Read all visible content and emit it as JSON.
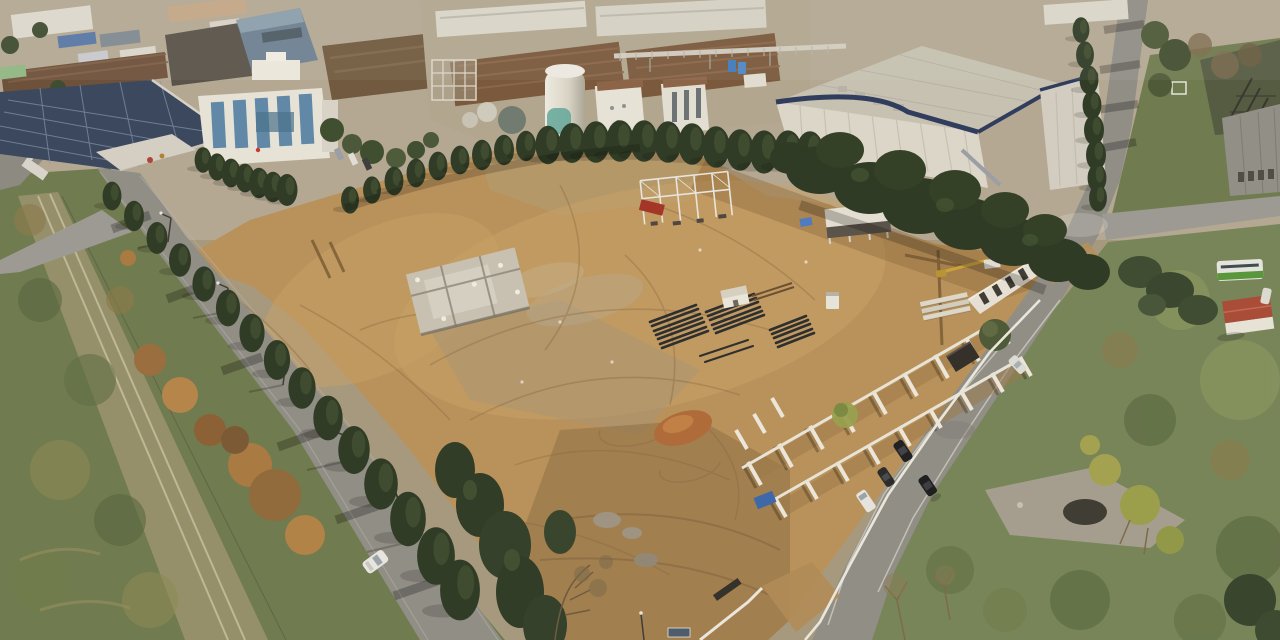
{
  "scene": {
    "kind": "aerial-drone-photograph",
    "subject": "Large cleared construction site with earthworks in an industrial district",
    "lighting": "low winter sun from upper right, long shadows cast to lower left",
    "season": "late autumn"
  },
  "palette": {
    "haze": "#b9b1a0",
    "earth": "#b9925c",
    "earth_light": "#cba76c",
    "earth_dark": "#8f6b42",
    "earth_gray": "#a59478",
    "grass": "#75855a",
    "grass_dark": "#55663f",
    "grass_light": "#8c9a62",
    "scrub": "#6d7a50",
    "tree_dark": "#2a3824",
    "tree_mid": "#3d4d30",
    "autumn": "#a87a42",
    "asphalt": "#8e8e88",
    "asphalt_light": "#9b9b95",
    "concrete": "#e9e7de",
    "concrete_shade": "#c6c3b6",
    "navy_fascia": "#2a3a5e",
    "solar_panel": "#36455e",
    "glass_blue": "#5d89ab",
    "roof_brown": "#77573d",
    "roof_red": "#a84a38",
    "silo_teal": "#5fa89e",
    "pipe_black": "#20262b",
    "tarp_blue": "#3a66ad",
    "machine_red": "#a33227",
    "crane_yellow": "#c9a33a",
    "bus_green": "#55963c",
    "rubble": "#c8c3b7"
  },
  "inventory": {
    "construction_site": [
      "cleared earth pad",
      "demolished building rubble",
      "steel frame under erection",
      "rows of precast L-shaped retaining walls",
      "stacks of black pipes",
      "reddish soil stockpile",
      "white site shed",
      "portable cabin",
      "blue tarp",
      "white perimeter fence with gate",
      "gravel piles"
    ],
    "buildings": [
      "warehouse with rooftop solar panels",
      "white office block with blue glazing",
      "blue-clad factory hall",
      "factory halls with brown roofs",
      "white silo with teal base",
      "elevated pipe bridge",
      "large white warehouse with navy fascia",
      "electrical substation",
      "small house with red roof",
      "precast concrete gallery"
    ],
    "roads": [
      "tree-lined road along the west side",
      "curving road along the east side",
      "side branch road to the east",
      "railway corridor at far left"
    ],
    "vehicles": {
      "white_car_west_road": 1,
      "cars_east_road": 4,
      "white_car_north_east_road": 1,
      "bus": 1,
      "mobile_crane": 1,
      "trucks": 2
    },
    "vegetation": [
      "cypress tree rows",
      "dense tree belt",
      "autumn orange trees",
      "green scrub fields",
      "bare winter trees"
    ]
  }
}
